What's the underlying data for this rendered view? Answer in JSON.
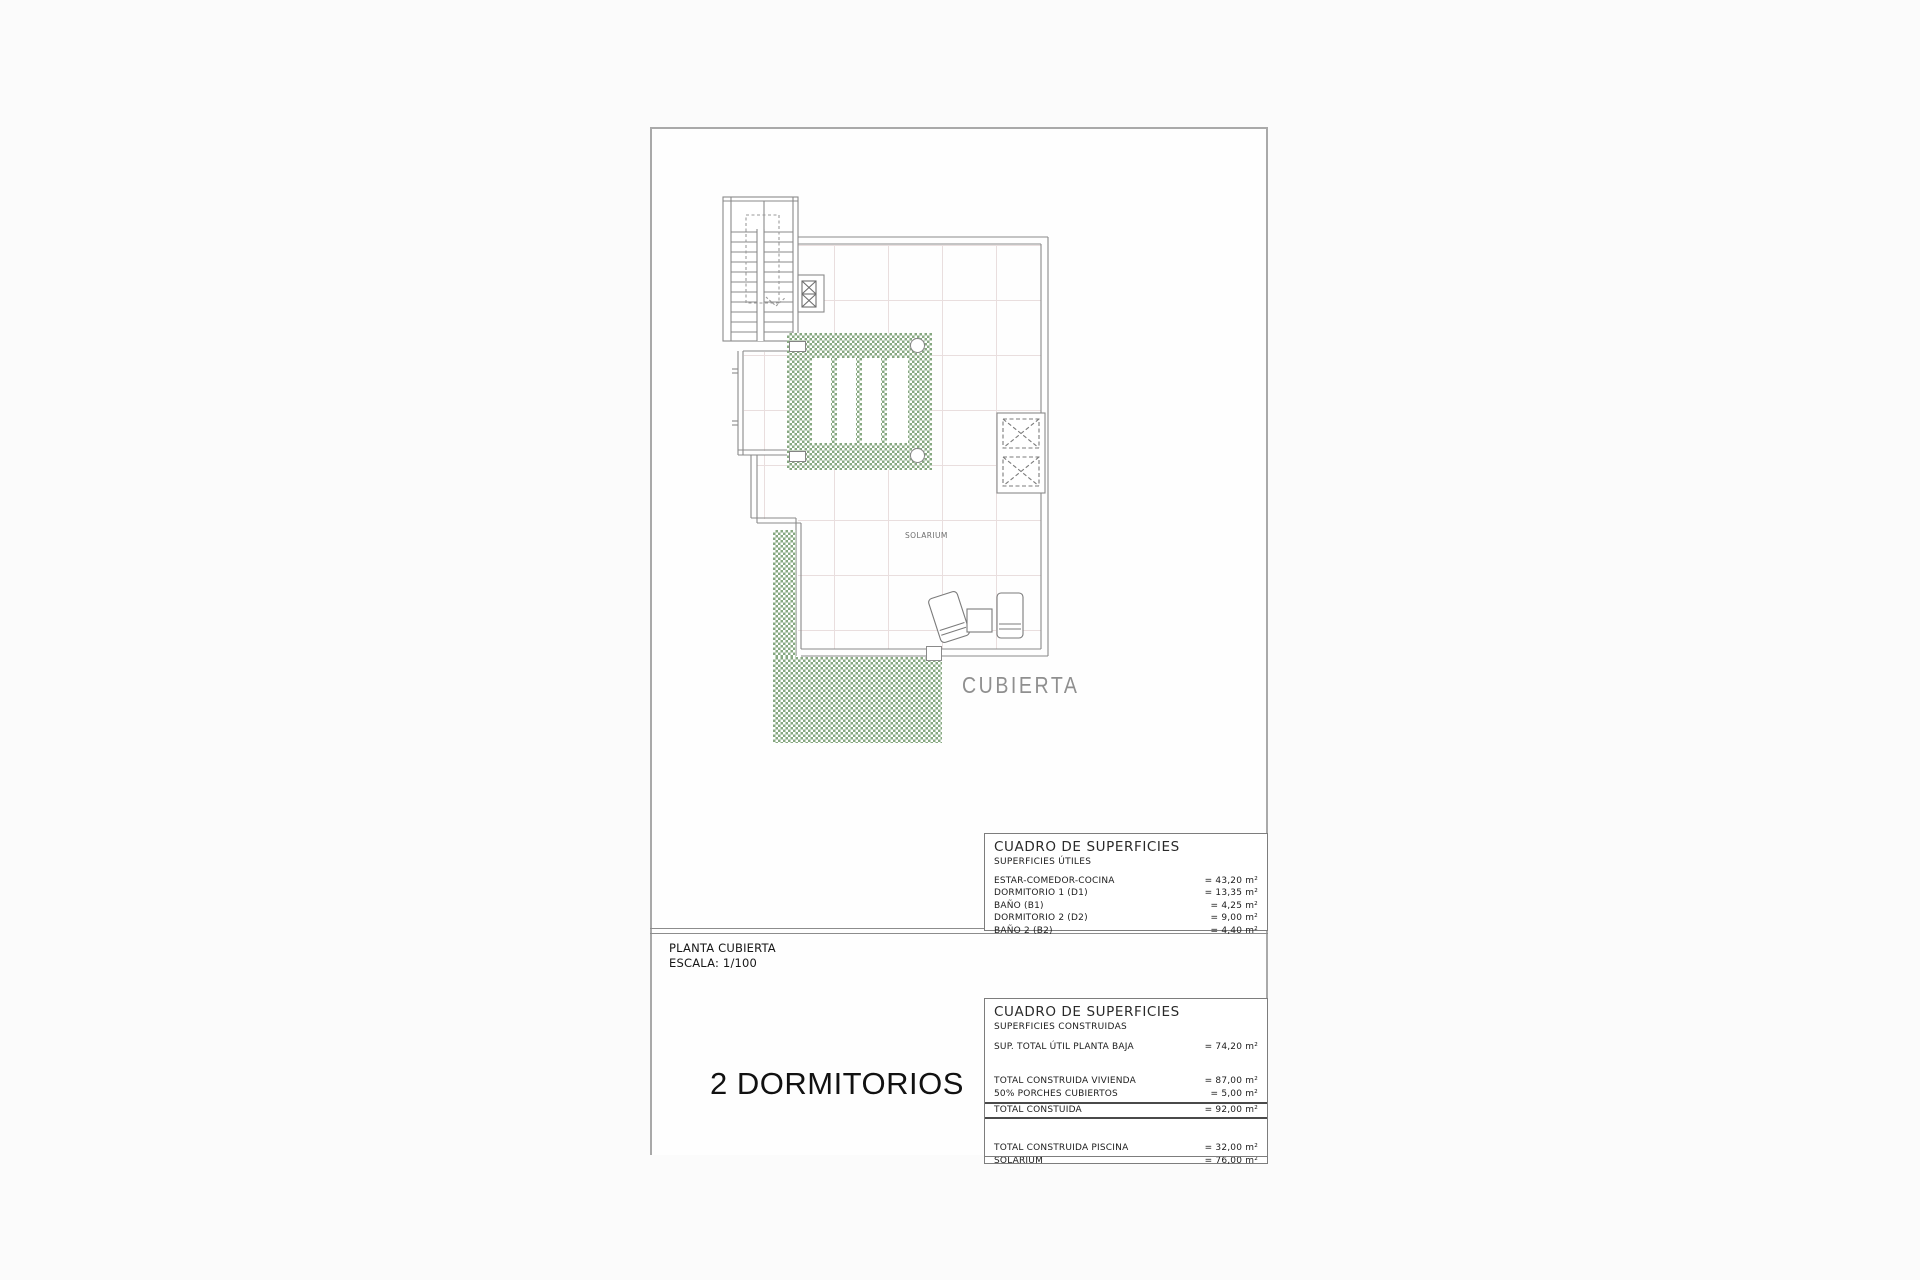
{
  "colors": {
    "hatch_green": "#87a881",
    "line_gray": "#8a8a8a",
    "grid_line": "#e9dede"
  },
  "plan": {
    "solarium_label": "SOLARIUM",
    "cubierta_label": "CUBIERTA"
  },
  "title_block": {
    "plan_name": "PLANTA CUBIERTA",
    "scale": "ESCALA: 1/100",
    "variant": "2 DORMITORIOS"
  },
  "tables": {
    "utiles": {
      "title": "CUADRO DE SUPERFICIES",
      "subtitle": "SUPERFICIES ÚTILES",
      "rows": [
        {
          "label": "ESTAR-COMEDOR-COCINA",
          "value": "= 43,20 m²"
        },
        {
          "label": "DORMITORIO 1 (D1)",
          "value": "= 13,35 m²"
        },
        {
          "label": "BAÑO  (B1)",
          "value": "= 4,25 m²"
        },
        {
          "label": "DORMITORIO 2 (D2)",
          "value": "= 9,00 m²"
        },
        {
          "label": "BAÑO 2 (B2)",
          "value": "= 4,40 m²"
        }
      ]
    },
    "construidas": {
      "title": "CUADRO DE SUPERFICIES",
      "subtitle": "SUPERFICIES CONSTRUIDAS",
      "rows_top": [
        {
          "label": "SUP. TOTAL ÚTIL PLANTA BAJA",
          "value": "= 74,20 m²"
        }
      ],
      "rows_mid": [
        {
          "label": "TOTAL CONSTRUIDA VIVIENDA",
          "value": "= 87,00 m²"
        },
        {
          "label": "50% PORCHES CUBIERTOS",
          "value": "= 5,00 m²"
        }
      ],
      "total": {
        "label": "TOTAL CONSTUIDA",
        "value": "= 92,00 m²"
      },
      "rows_bottom": [
        {
          "label": "TOTAL CONSTRUIDA PISCINA",
          "value": "= 32,00 m²"
        },
        {
          "label": "SOLARIUM",
          "value": "= 76,00 m²"
        }
      ]
    }
  }
}
